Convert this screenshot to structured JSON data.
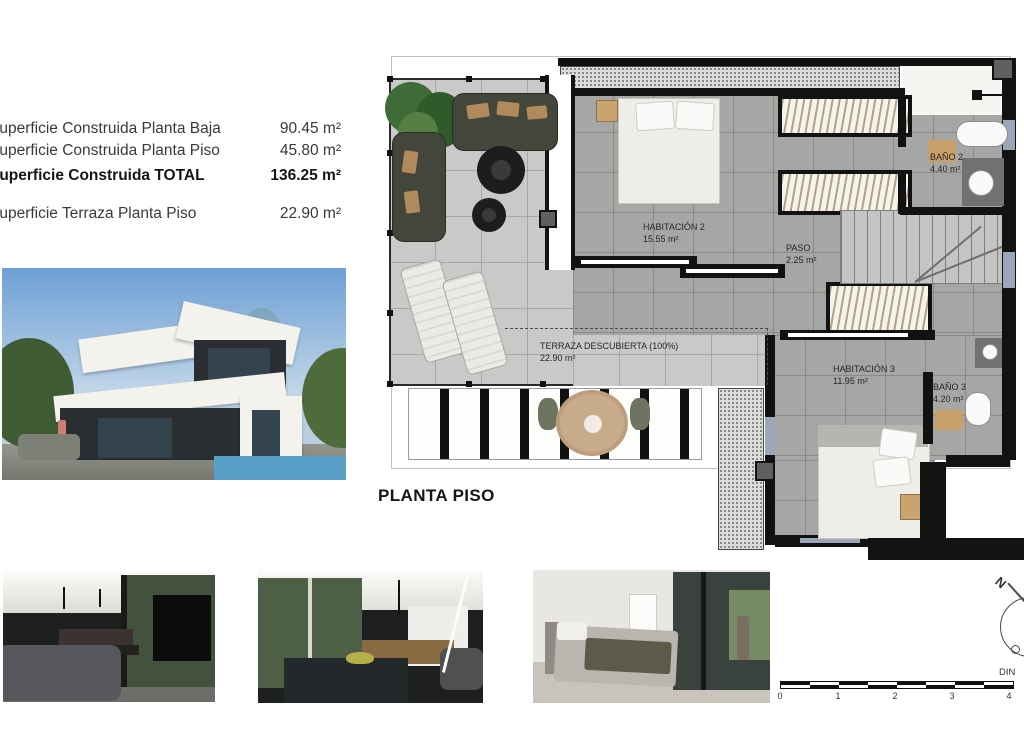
{
  "summary": {
    "rows": [
      {
        "label": "Superficie Construida Planta Baja",
        "value": "90.45 m²"
      },
      {
        "label": "Superficie Construida Planta Piso",
        "value": "45.80 m²"
      },
      {
        "label": "Superficie Construida TOTAL",
        "value": "136.25 m²"
      },
      {
        "label": "Superficie Terraza Planta Piso",
        "value": "22.90 m²"
      }
    ]
  },
  "plan": {
    "title": "PLANTA PISO",
    "rooms": [
      {
        "name": "HABITACIÓN 2",
        "area": "15.55 m²"
      },
      {
        "name": "BAÑO 2",
        "area": "4.40 m²"
      },
      {
        "name": "PASO",
        "area": "2.25 m²"
      },
      {
        "name": "HABITACIÓN 3",
        "area": "11.95 m²"
      },
      {
        "name": "BAÑO 3",
        "area": "4.20 m²"
      },
      {
        "name": "TERRAZA DESCUBIERTA (100%)",
        "area": "22.90 m²"
      }
    ]
  },
  "scale_bar": {
    "ticks": [
      "0",
      "1",
      "2",
      "3",
      "4"
    ],
    "din_label": "DIN"
  },
  "compass": {
    "north_label": "N"
  },
  "colors": {
    "wall": "#121212",
    "terrace_tile": "#c9c9c7",
    "interior_tile": "#a6a6a4",
    "wood_accent": "#c8a06a"
  }
}
